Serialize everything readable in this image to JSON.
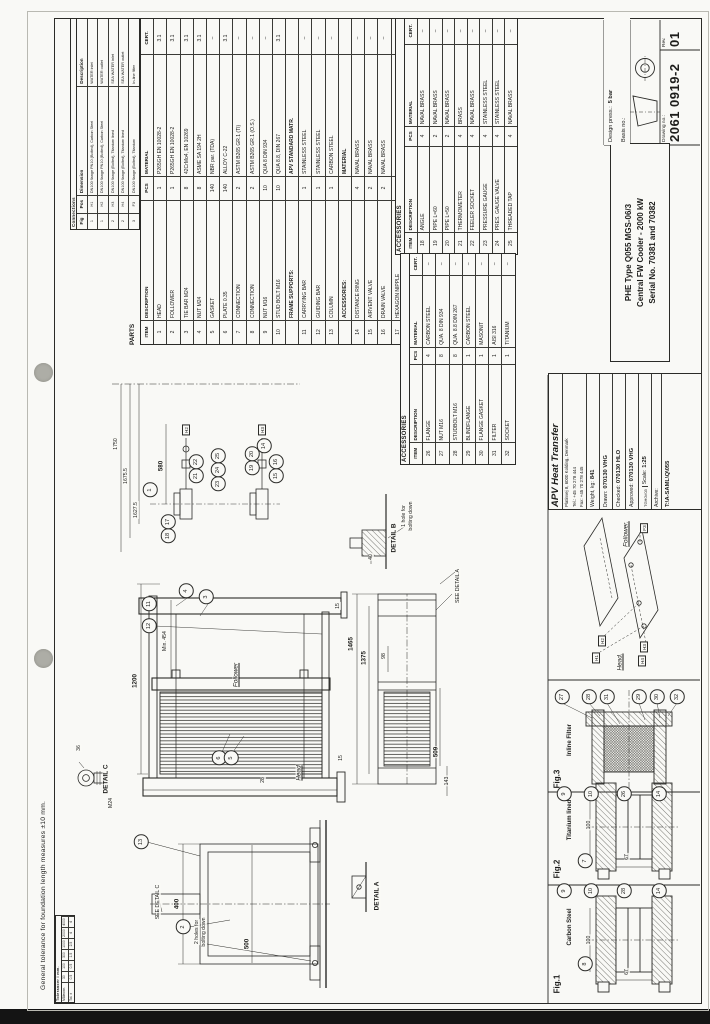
{
  "sheet": {
    "tolerance_note": "General tolerance for foundation length measures ±10 mm.",
    "paper_color": "#f9f9f6",
    "line_color": "#2b2b28",
    "scan_strip_color": "#141414"
  },
  "mini_table": {
    "title": "Tolerancer i mm.",
    "rows": [
      [
        "Måleomr.",
        "30",
        "100",
        "300",
        "1000",
        "2000",
        "4000"
      ],
      [
        "Tol. ±",
        "0.5",
        "0.5",
        "1.5",
        "2.5",
        "4",
        "4"
      ]
    ]
  },
  "connections_table": {
    "title": "Connections",
    "headers": [
      "Fig",
      "Pos",
      "Dimension",
      "Description"
    ],
    "rows": [
      [
        "1",
        "H1",
        "DN100 flange PN10 (Bolted), Carbon Steel",
        "WATER inlet"
      ],
      [
        "1",
        "H2",
        "DN100 flange PN10 (Bolted), Carbon Steel",
        "WATER outlet"
      ],
      [
        "2",
        "H3",
        "DN100 flange (Bolted), Titanium lined",
        "SEA WATER inlet"
      ],
      [
        "2",
        "H4",
        "DN100 flange (Bolted), Titanium lined",
        "SEA WATER outlet"
      ],
      [
        "3",
        "F3",
        "DN100 flange (Bolted), Titanium",
        "In-line filter"
      ]
    ]
  },
  "parts_table": {
    "title": "PARTS",
    "headers": [
      "ITEM",
      "DESCRIPTION",
      "PCS",
      "MATERIAL",
      "CERT."
    ],
    "rows": [
      [
        "1",
        "HEAD",
        "1",
        "P265GH EN 10028-2",
        "3.1"
      ],
      [
        "2",
        "FOLLOWER",
        "1",
        "P265GH EN 10028-2",
        "3.1"
      ],
      [
        "3",
        "TIE BAR M24",
        "8",
        "42CrMo4, EN 10269",
        "3.1"
      ],
      [
        "4",
        "NUT M24",
        "8",
        "ASME SA 194 2H",
        "3.1"
      ],
      [
        "5",
        "GASKET",
        "140",
        "NBR par. (TDA)",
        "–"
      ],
      [
        "6",
        "PLATE 0.35",
        "140",
        "ALLOY C-22",
        "3.1"
      ],
      [
        "7",
        "CONNECTION",
        "2",
        "ASTM B265 GR.1 (TI)",
        "–"
      ],
      [
        "8",
        "CONNECTION",
        "2",
        "ASTM B265 GR.1 (O.S.)",
        "–"
      ],
      [
        "9",
        "NUT M16",
        "10",
        "QUA 8 DIN 934",
        "–"
      ],
      [
        "10",
        "STUD BOLT M16",
        "10",
        "QUA 8.8, DIN 267",
        "3.1"
      ],
      [
        "",
        "FRAME SUPPORTS:",
        "",
        "APV STANDARD MATR.",
        ""
      ],
      [
        "11",
        "CARRYING BAR",
        "1",
        "STAINLESS STEEL",
        "–"
      ],
      [
        "12",
        "GUIDING BAR",
        "1",
        "STAINLESS STEEL",
        "–"
      ],
      [
        "13",
        "COLUMN",
        "1",
        "CARBON STEEL",
        "–"
      ],
      [
        "",
        "ACCESSORIES:",
        "",
        "MATERIAL",
        ""
      ],
      [
        "14",
        "DISTANCE RING",
        "4",
        "NAVAL BRASS",
        "–"
      ],
      [
        "15",
        "AIRVENT VALVE",
        "2",
        "NAVAL BRASS",
        "–"
      ],
      [
        "16",
        "DRAIN VALVE",
        "2",
        "NAVAL BRASS",
        "–"
      ],
      [
        "17",
        "HEXAGON NIPPLE",
        "4",
        "NAVAL BRASS",
        "–"
      ]
    ]
  },
  "acc_table_1": {
    "title": "ACCESSORIES",
    "headers": [
      "ITEM",
      "DESCRIPTION",
      "PCS",
      "MATERIAL",
      "CERT."
    ],
    "rows": [
      [
        "18",
        "ANGLE",
        "4",
        "NAVAL BRASS",
        "–"
      ],
      [
        "19",
        "PIPE  L=60",
        "2",
        "NAVAL BRASS",
        "–"
      ],
      [
        "20",
        "PIPE  L=50",
        "2",
        "NAVAL BRASS",
        "–"
      ],
      [
        "21",
        "THERMOMETER",
        "4",
        "BRASS",
        "–"
      ],
      [
        "22",
        "FEELER SOCKET",
        "4",
        "NAVAL BRASS",
        "–"
      ],
      [
        "23",
        "PRESSURE GAUGE",
        "4",
        "STAINLESS STEEL",
        "–"
      ],
      [
        "24",
        "PRES. GAUGE VALVE",
        "4",
        "STAINLESS STEEL",
        "–"
      ],
      [
        "25",
        "THREADED TAP",
        "4",
        "NAVAL BRASS",
        "–"
      ]
    ]
  },
  "acc_table_2": {
    "title": "ACCESSORIES",
    "headers": [
      "ITEM",
      "DESCRIPTION",
      "PCS",
      "MATERIAL",
      "CERT."
    ],
    "rows": [
      [
        "26",
        "FLANGE",
        "4",
        "CARBON STEEL",
        "–"
      ],
      [
        "27",
        "NUT M16",
        "8",
        "QUA. 8 DIN 934",
        "–"
      ],
      [
        "28",
        "STUDBOLT M16",
        "8",
        "QUA. 8.8 DIN 267",
        "–"
      ],
      [
        "29",
        "BLINDFLANGE",
        "1",
        "CARBON STEEL",
        "–"
      ],
      [
        "30",
        "FLANGE GASKET",
        "1",
        "MASONIT",
        "–"
      ],
      [
        "31",
        "FILTER",
        "1",
        "AISI 316",
        "–"
      ],
      [
        "32",
        "SOCKET",
        "1",
        "TITANIUM",
        "–"
      ]
    ]
  },
  "title_block": {
    "company": "APV Heat Transfer",
    "address": "Platinvej 8, 6000 Kolding, Denmark",
    "tel": "Tel.: +45 70 278 444",
    "fax": "Fax: +45 70 278 445",
    "weight_label": "Weight, kg:",
    "weight_value": "841",
    "drawn_label": "Drawn:",
    "drawn_value": "070130 VHG",
    "checked_label": "Checked:",
    "checked_value": "070130 HLO",
    "approved_label": "Approved:",
    "approved_value": "070130 VHG",
    "ref_code": "TGH0V03",
    "scale_label": "Scale:",
    "scale_value": "1:25",
    "archive_label": "Archive:",
    "archive_path": "T:\\A-SAML\\Q\\055",
    "product_line_1": "PHE Type Q055  MGS-06/3",
    "product_line_2": "Central FW Cooler  -  2000 kW",
    "product_line_3": "Serial No.  70381  and  70382",
    "design_press_label": "Design press.:",
    "design_press_value": "5 bar",
    "basis_label": "Basis no.:",
    "drawing_no_label": "Drawing no.:",
    "drawing_no": "2061 0919-2",
    "rev_label": "Rev.",
    "rev": "01"
  },
  "drawing": {
    "labels": [
      {
        "t": "1200",
        "x": 343,
        "y": 135,
        "c": "dimb"
      },
      {
        "t": "Min. 454",
        "x": 383,
        "y": 165,
        "c": "sm"
      },
      {
        "t": "Follower",
        "x": 349,
        "y": 236,
        "c": "itu"
      },
      {
        "t": "Head",
        "x": 251,
        "y": 299,
        "c": "itu"
      },
      {
        "t": "28",
        "x": 244,
        "y": 263,
        "c": "sm"
      },
      {
        "t": "15",
        "x": 418,
        "y": 338,
        "c": "sm"
      },
      {
        "t": "15",
        "x": 266,
        "y": 341,
        "c": "sm"
      },
      {
        "t": "1465",
        "x": 380,
        "y": 351,
        "c": "dimb"
      },
      {
        "t": "1375",
        "x": 366,
        "y": 364,
        "c": "dimb"
      },
      {
        "t": "98",
        "x": 368,
        "y": 384,
        "c": "sm"
      },
      {
        "t": "509",
        "x": 272,
        "y": 436,
        "c": "dimb"
      },
      {
        "t": "143",
        "x": 243,
        "y": 447,
        "c": "sm"
      },
      {
        "t": "400",
        "x": 120,
        "y": 177,
        "c": "dimb"
      },
      {
        "t": "500",
        "x": 80,
        "y": 247,
        "c": "dimb"
      },
      {
        "t": "SEE DETAIL C",
        "x": 122,
        "y": 158,
        "c": "sm"
      },
      {
        "t": "2 holes for",
        "x": 92,
        "y": 197,
        "c": "sm"
      },
      {
        "t": "bolting down",
        "x": 92,
        "y": 204,
        "c": "sm"
      },
      {
        "t": "SEE DETAIL A",
        "x": 438,
        "y": 458,
        "c": "sm"
      },
      {
        "t": "DETAIL A",
        "x": 128,
        "y": 377,
        "c": "b"
      },
      {
        "t": "DETAIL B",
        "x": 486,
        "y": 394,
        "c": "b"
      },
      {
        "t": "1 hole for",
        "x": 508,
        "y": 404,
        "c": "sm"
      },
      {
        "t": "bolting down",
        "x": 508,
        "y": 411,
        "c": "sm"
      },
      {
        "t": "40",
        "x": 467,
        "y": 371,
        "c": "sm"
      },
      {
        "t": "DETAIL C",
        "x": 245,
        "y": 106,
        "c": "b"
      },
      {
        "t": "36",
        "x": 276,
        "y": 79,
        "c": "sm"
      },
      {
        "t": "M24",
        "x": 221,
        "y": 111,
        "c": "sm"
      },
      {
        "t": "580",
        "x": 558,
        "y": 161,
        "c": "dimb"
      },
      {
        "t": "1750",
        "x": 580,
        "y": 116,
        "c": "sm"
      },
      {
        "t": "1675.5",
        "x": 548,
        "y": 126,
        "c": "sm"
      },
      {
        "t": "1627.5",
        "x": 514,
        "y": 136,
        "c": "sm"
      },
      {
        "t": "Fig.1",
        "x": 40,
        "y": 557,
        "c": "fig"
      },
      {
        "t": "Carbon Steel",
        "x": 97,
        "y": 570,
        "c": "figsub"
      },
      {
        "t": "Fig.2",
        "x": 155,
        "y": 557,
        "c": "fig"
      },
      {
        "t": "Titanium lined",
        "x": 204,
        "y": 570,
        "c": "figsub"
      },
      {
        "t": "Fig.3",
        "x": 245,
        "y": 557,
        "c": "fig"
      },
      {
        "t": "Inline Filter",
        "x": 284,
        "y": 570,
        "c": "figsub"
      },
      {
        "t": "100",
        "x": 84,
        "y": 589,
        "c": "sm"
      },
      {
        "t": "100",
        "x": 199,
        "y": 589,
        "c": "sm"
      },
      {
        "t": "67",
        "x": 52,
        "y": 627,
        "c": "sm"
      },
      {
        "t": "67",
        "x": 167,
        "y": 627,
        "c": "sm"
      },
      {
        "t": "Follower.",
        "x": 490,
        "y": 626,
        "c": "itu"
      },
      {
        "t": "Head.",
        "x": 362,
        "y": 620,
        "c": "itu"
      }
    ],
    "balloons": [
      {
        "n": "12",
        "x": 398,
        "y": 149
      },
      {
        "n": "11",
        "x": 420,
        "y": 149
      },
      {
        "n": "4",
        "x": 433,
        "y": 186
      },
      {
        "n": "3",
        "x": 427,
        "y": 206
      },
      {
        "n": "6",
        "x": 266,
        "y": 219
      },
      {
        "n": "5",
        "x": 266,
        "y": 231
      },
      {
        "n": "13",
        "x": 182,
        "y": 141
      },
      {
        "n": "2",
        "x": 97,
        "y": 183
      },
      {
        "n": "1",
        "x": 534,
        "y": 150
      },
      {
        "n": "18",
        "x": 488,
        "y": 168
      },
      {
        "n": "17",
        "x": 502,
        "y": 168
      },
      {
        "n": "21",
        "x": 548,
        "y": 196
      },
      {
        "n": "22",
        "x": 562,
        "y": 196
      },
      {
        "n": "23",
        "x": 540,
        "y": 218
      },
      {
        "n": "24",
        "x": 554,
        "y": 218
      },
      {
        "n": "25",
        "x": 568,
        "y": 218
      },
      {
        "n": "19",
        "x": 556,
        "y": 252
      },
      {
        "n": "20",
        "x": 570,
        "y": 252
      },
      {
        "n": "15",
        "x": 548,
        "y": 276
      },
      {
        "n": "16",
        "x": 562,
        "y": 276
      },
      {
        "n": "14",
        "x": 578,
        "y": 264
      },
      {
        "n": "9",
        "x": 133,
        "y": 564
      },
      {
        "n": "10",
        "x": 133,
        "y": 591
      },
      {
        "n": "28",
        "x": 133,
        "y": 624
      },
      {
        "n": "14",
        "x": 133,
        "y": 659
      },
      {
        "n": "8",
        "x": 60,
        "y": 585
      },
      {
        "n": "9",
        "x": 230,
        "y": 564
      },
      {
        "n": "10",
        "x": 230,
        "y": 591
      },
      {
        "n": "26",
        "x": 230,
        "y": 624
      },
      {
        "n": "14",
        "x": 230,
        "y": 659
      },
      {
        "n": "7",
        "x": 163,
        "y": 585
      },
      {
        "n": "27",
        "x": 327,
        "y": 562
      },
      {
        "n": "28",
        "x": 327,
        "y": 589
      },
      {
        "n": "31",
        "x": 327,
        "y": 607
      },
      {
        "n": "29",
        "x": 327,
        "y": 639
      },
      {
        "n": "30",
        "x": 327,
        "y": 657
      },
      {
        "n": "32",
        "x": 327,
        "y": 677
      }
    ],
    "ref_boxes": [
      {
        "t": "H1",
        "x": 366,
        "y": 596
      },
      {
        "t": "H2",
        "x": 383,
        "y": 602
      },
      {
        "t": "H3",
        "x": 377,
        "y": 644
      },
      {
        "t": "H4",
        "x": 363,
        "y": 642
      },
      {
        "t": "F3",
        "x": 496,
        "y": 644
      },
      {
        "t": "H2",
        "x": 594,
        "y": 186
      },
      {
        "t": "H3",
        "x": 594,
        "y": 262
      }
    ]
  }
}
